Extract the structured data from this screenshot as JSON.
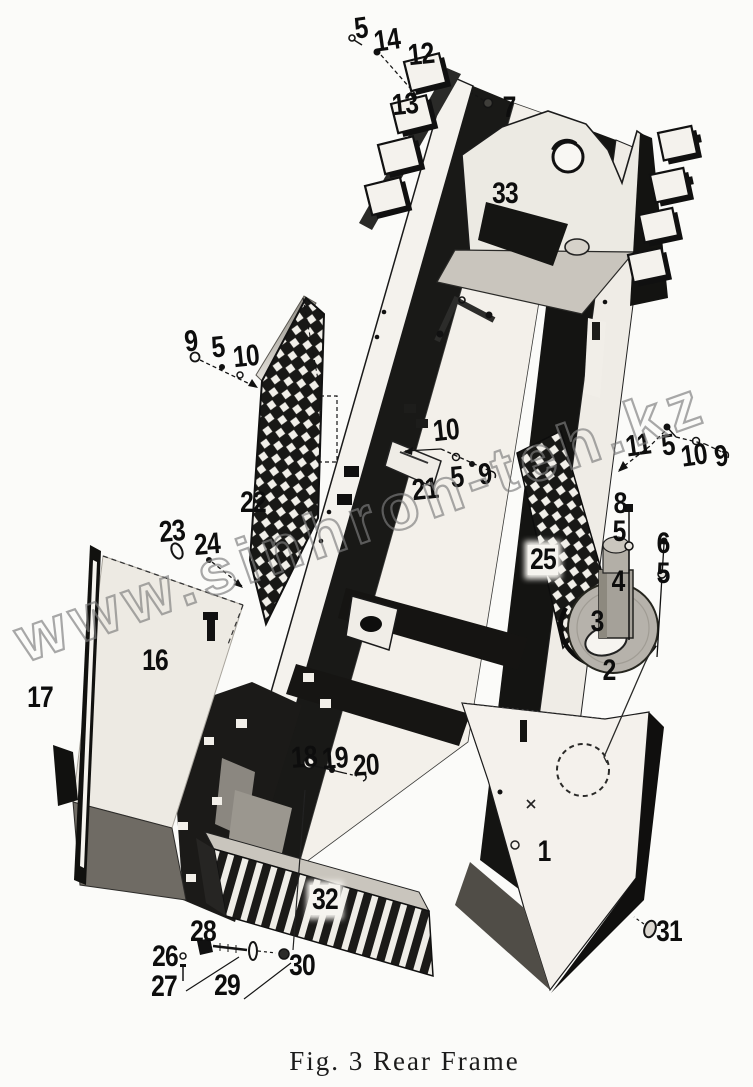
{
  "figure": {
    "caption": "Fig. 3 Rear Frame",
    "watermark": "www.sinhron-teh.kz",
    "description": "Exploded parts diagram of rear frame assembly"
  },
  "colors": {
    "ink": "#141414",
    "paper": "#fbfbf9",
    "watermark_gray": "#7d7d7d"
  },
  "part_labels": [
    {
      "text": "5",
      "x": 361,
      "y": 29,
      "r": -8
    },
    {
      "text": "14",
      "x": 387,
      "y": 41,
      "r": -8
    },
    {
      "text": "12",
      "x": 421,
      "y": 55,
      "r": -6
    },
    {
      "text": "13",
      "x": 405,
      "y": 105,
      "r": -6
    },
    {
      "text": "7",
      "x": 509,
      "y": 108,
      "r": 0
    },
    {
      "text": "33",
      "x": 505,
      "y": 194,
      "r": 0
    },
    {
      "text": "9",
      "x": 191,
      "y": 342,
      "r": -6
    },
    {
      "text": "5",
      "x": 218,
      "y": 348,
      "r": -6
    },
    {
      "text": "10",
      "x": 246,
      "y": 357,
      "r": -6
    },
    {
      "text": "10",
      "x": 446,
      "y": 431,
      "r": -6
    },
    {
      "text": "21",
      "x": 425,
      "y": 490,
      "r": -6
    },
    {
      "text": "5",
      "x": 457,
      "y": 478,
      "r": -6
    },
    {
      "text": "9",
      "x": 485,
      "y": 475,
      "r": -6
    },
    {
      "text": "11",
      "x": 638,
      "y": 446,
      "r": -8
    },
    {
      "text": "5",
      "x": 668,
      "y": 446,
      "r": -8
    },
    {
      "text": "10",
      "x": 694,
      "y": 456,
      "r": -8
    },
    {
      "text": "9",
      "x": 721,
      "y": 457,
      "r": -8
    },
    {
      "text": "8",
      "x": 620,
      "y": 504,
      "r": 0
    },
    {
      "text": "5",
      "x": 619,
      "y": 532,
      "r": 0
    },
    {
      "text": "6",
      "x": 663,
      "y": 544,
      "r": 0
    },
    {
      "text": "5",
      "x": 663,
      "y": 574,
      "r": 0
    },
    {
      "text": "4",
      "x": 618,
      "y": 582,
      "r": 0
    },
    {
      "text": "3",
      "x": 597,
      "y": 622,
      "r": 0
    },
    {
      "text": "2",
      "x": 609,
      "y": 671,
      "r": 0
    },
    {
      "text": "25",
      "x": 543,
      "y": 560,
      "r": 0,
      "bg": true
    },
    {
      "text": "22",
      "x": 253,
      "y": 503,
      "r": 0
    },
    {
      "text": "23",
      "x": 172,
      "y": 532,
      "r": -5
    },
    {
      "text": "24",
      "x": 207,
      "y": 545,
      "r": -5
    },
    {
      "text": "16",
      "x": 155,
      "y": 661,
      "r": 0
    },
    {
      "text": "17",
      "x": 40,
      "y": 698,
      "r": 0
    },
    {
      "text": "18",
      "x": 304,
      "y": 758,
      "r": -4
    },
    {
      "text": "19",
      "x": 335,
      "y": 759,
      "r": -4
    },
    {
      "text": "20",
      "x": 366,
      "y": 766,
      "r": -4
    },
    {
      "text": "32",
      "x": 325,
      "y": 900,
      "r": 0,
      "bg": true
    },
    {
      "text": "28",
      "x": 203,
      "y": 932,
      "r": 0
    },
    {
      "text": "26",
      "x": 165,
      "y": 957,
      "r": 0
    },
    {
      "text": "27",
      "x": 164,
      "y": 987,
      "r": 0
    },
    {
      "text": "29",
      "x": 227,
      "y": 986,
      "r": 0
    },
    {
      "text": "30",
      "x": 302,
      "y": 966,
      "r": 0
    },
    {
      "text": "1",
      "x": 544,
      "y": 852,
      "r": 0
    },
    {
      "text": "31",
      "x": 669,
      "y": 932,
      "r": 0
    }
  ]
}
